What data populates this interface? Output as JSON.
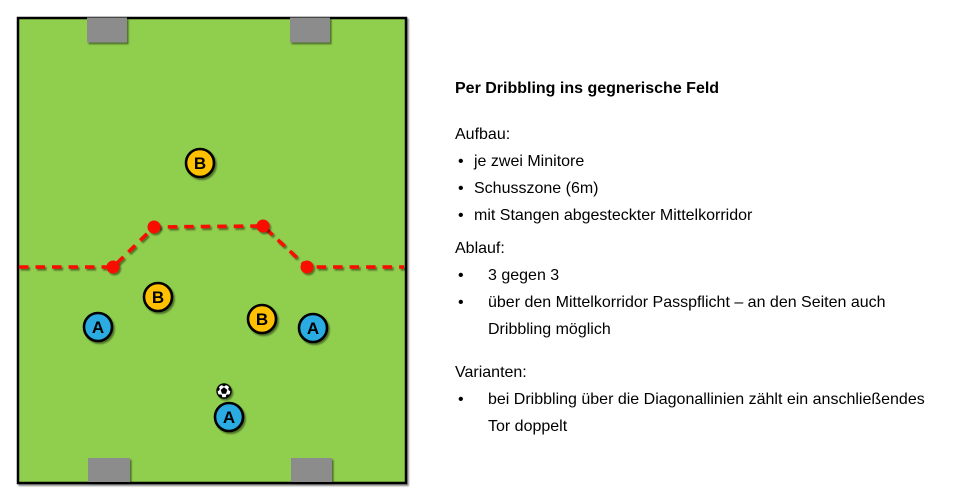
{
  "colors": {
    "background": "#FFFFFF",
    "field_green": "#90CE4E",
    "goal_gray": "#8C8C8C",
    "line_black": "#000000",
    "corridor_red": "#F80D06",
    "team_a_blue": "#29ABE2",
    "team_b_orange": "#FFC000",
    "ball_white": "#FFFFFF"
  },
  "pitch": {
    "players": [
      {
        "team": "B",
        "label": "B"
      },
      {
        "team": "B",
        "label": "B"
      },
      {
        "team": "B",
        "label": "B"
      },
      {
        "team": "A",
        "label": "A"
      },
      {
        "team": "A",
        "label": "A"
      },
      {
        "team": "A",
        "label": "A"
      }
    ]
  },
  "panel": {
    "title": "Per Dribbling ins gegnerische Feld",
    "bullet_char": "•",
    "sections": [
      {
        "heading": "Aufbau:",
        "bullets": [
          "je zwei Minitore",
          "Schusszone (6m)",
          "mit Stangen abgesteckter Mittelkorridor"
        ]
      },
      {
        "heading": "Ablauf:",
        "bullets": [
          "3 gegen 3",
          "über den Mittelkorridor Passpflicht – an den Seiten auch Dribbling möglich"
        ]
      },
      {
        "heading": "Varianten:",
        "bullets": [
          "bei Dribbling über die Diagonallinien zählt ein anschließendes Tor doppelt"
        ]
      }
    ]
  }
}
